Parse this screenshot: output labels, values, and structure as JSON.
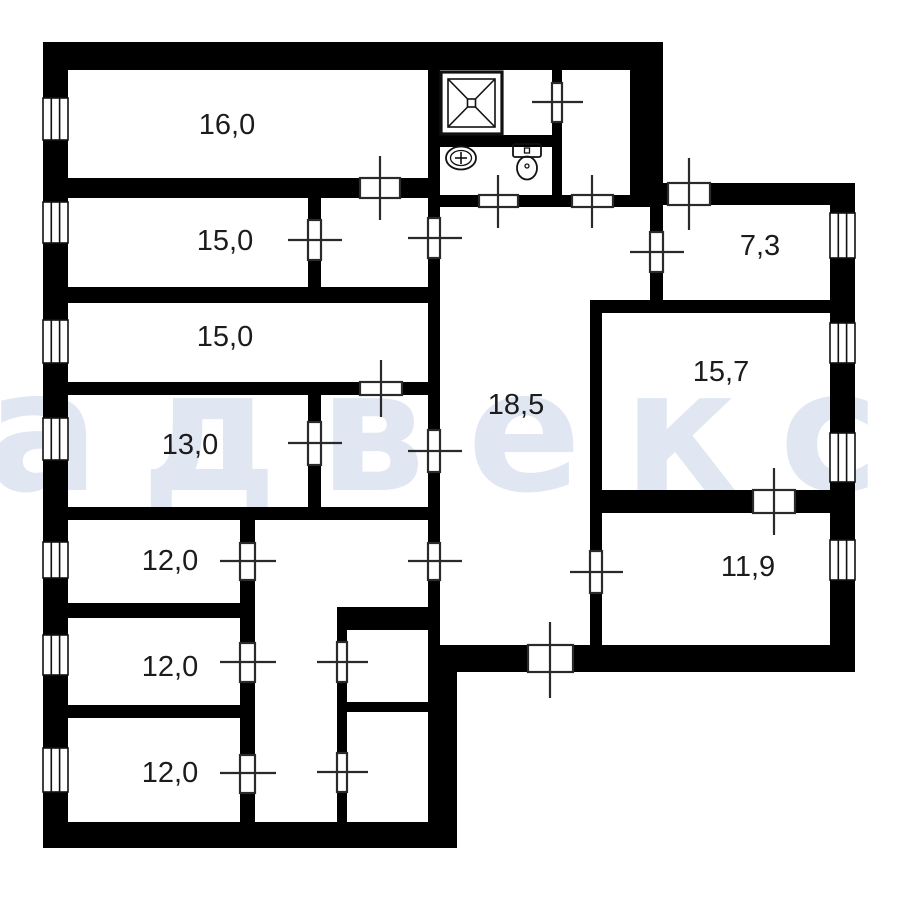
{
  "plan": {
    "type": "apartment-floor-plan",
    "watermark": {
      "text": "адвекс"
    },
    "rooms": [
      {
        "id": "room-16-0",
        "label": "16,0"
      },
      {
        "id": "room-15-0-a",
        "label": "15,0"
      },
      {
        "id": "room-15-0-b",
        "label": "15,0"
      },
      {
        "id": "room-13-0",
        "label": "13,0"
      },
      {
        "id": "room-12-0-a",
        "label": "12,0"
      },
      {
        "id": "room-12-0-b",
        "label": "12,0"
      },
      {
        "id": "room-12-0-c",
        "label": "12,0"
      },
      {
        "id": "hall-18-5",
        "label": "18,5"
      },
      {
        "id": "room-7-3",
        "label": "7,3"
      },
      {
        "id": "room-15-7",
        "label": "15,7"
      },
      {
        "id": "room-11-9",
        "label": "11,9"
      }
    ],
    "fixtures": [
      "shower-tray",
      "washbasin",
      "toilet"
    ],
    "symbols": {
      "window_count": 11,
      "door_count": 20
    }
  },
  "colors": {
    "wall": "#000000",
    "background": "#ffffff",
    "watermark": "#e0e7f2",
    "label": "#1c1c1c",
    "door_line": "#2a2a2a",
    "symbol_stroke": "#111111",
    "window_fill": "#ffffff"
  }
}
